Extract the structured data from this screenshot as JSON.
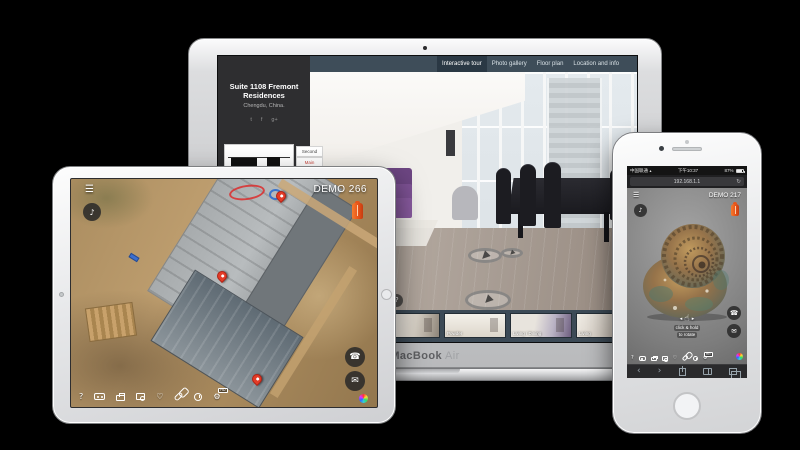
{
  "scene": {
    "background_color": "#000000"
  },
  "glyphs": {
    "menu": "☰",
    "music": "♪",
    "phone": "☎",
    "mail": "✉",
    "heart": "♡",
    "gear": "⚙",
    "help": "?",
    "refresh": "↻",
    "back": "‹",
    "forward": "›",
    "hand": "☝",
    "arrow_left": "◂",
    "arrow_right": "▸",
    "wifi": "▴"
  },
  "macbook": {
    "device_label": {
      "bold": "MacBook",
      "light": "Air"
    },
    "nav_tabs": [
      {
        "label": "Interactive tour",
        "active": true
      },
      {
        "label": "Photo gallery",
        "active": false
      },
      {
        "label": "Floor plan",
        "active": false
      },
      {
        "label": "Location and info",
        "active": false
      }
    ],
    "sidebar": {
      "title": "Suite 1108 Fremont Residences",
      "location": "Chengdu, China.",
      "social": [
        {
          "name": "twitter",
          "glyph": "t"
        },
        {
          "name": "facebook",
          "glyph": "f"
        },
        {
          "name": "google-plus",
          "glyph": "g+"
        }
      ],
      "floor_buttons": [
        {
          "label": "Second"
        },
        {
          "label": "Main"
        }
      ]
    },
    "thumbnails": [
      {
        "label": ""
      },
      {
        "label": "Entry"
      },
      {
        "label": "Powder"
      },
      {
        "label": "Living / Dining"
      },
      {
        "label": "Living"
      }
    ]
  },
  "ipad": {
    "demo_label": "DEMO 266",
    "toolbar_badge": "HD"
  },
  "iphone": {
    "status": {
      "carrier": "中国联通",
      "time": "下午10:37",
      "battery": "87%"
    },
    "address_bar": {
      "url": "192.168.1.1"
    },
    "demo_label": "DEMO 217",
    "rotate_hint": {
      "line1": "click & hold",
      "line2": "to rotate"
    },
    "toolbar_badge": "HD"
  }
}
